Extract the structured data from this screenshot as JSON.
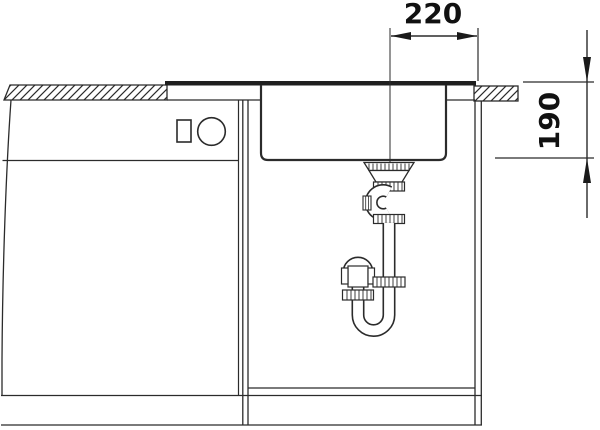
{
  "drawing": {
    "type": "sink-installation-section-drawing",
    "dimensions": {
      "width": {
        "value": "220"
      },
      "depth": {
        "value": "190"
      }
    },
    "colors": {
      "line": "#2b2b2b",
      "text": "#111111",
      "rim_fill": "#1f1f1f",
      "background": "#ffffff"
    }
  }
}
